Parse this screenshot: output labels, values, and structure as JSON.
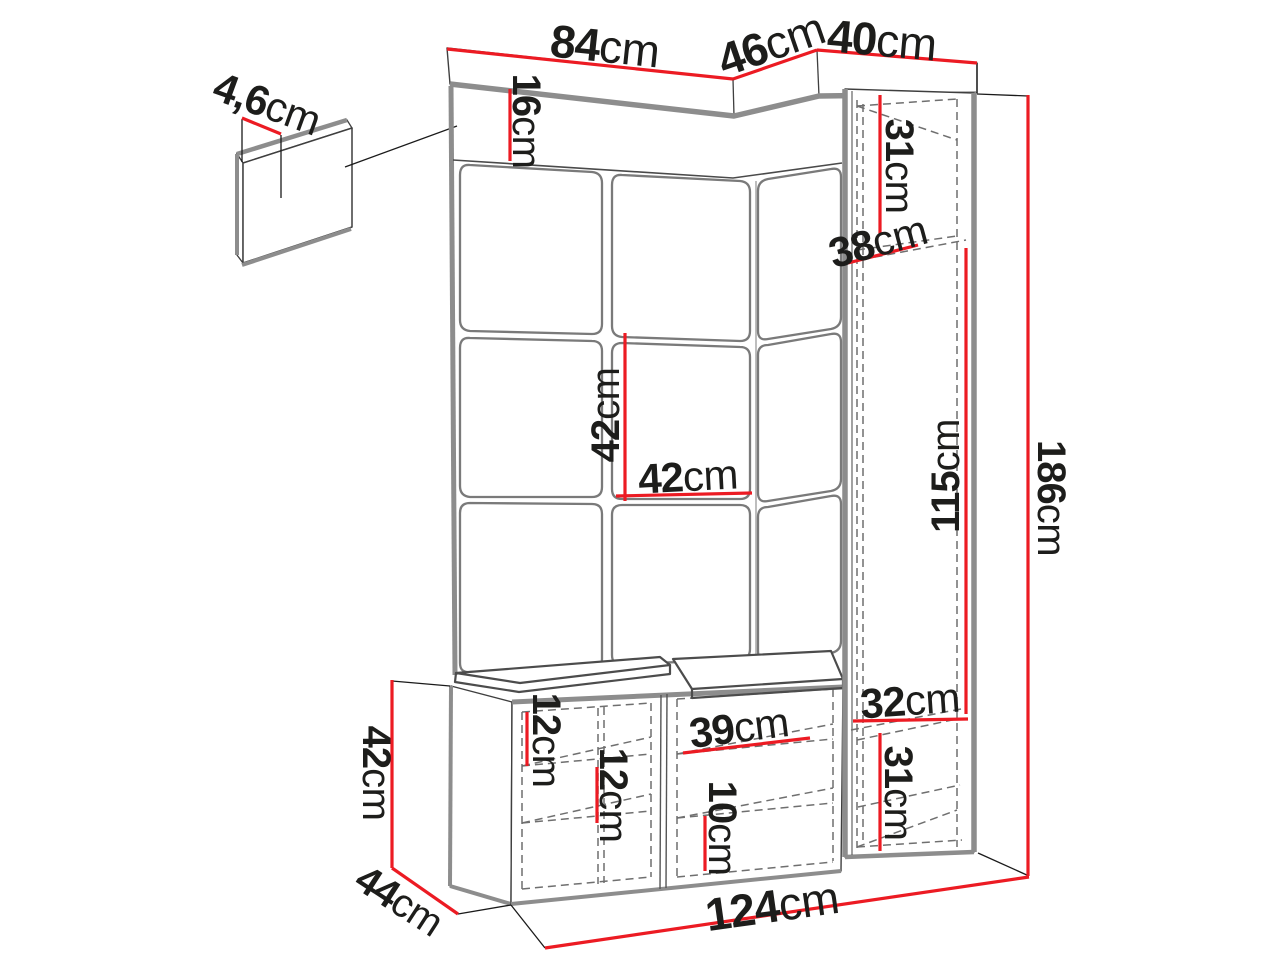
{
  "colors": {
    "dimension_red": "#ec1b23",
    "outline_dark": "#3f3f3f",
    "structure_gray": "#8d8d8d",
    "ink": "#1d1d1b"
  },
  "icons": {
    "coat_hook": "double-coat-hook-icon"
  },
  "labels": [
    {
      "id": "panel-row-top-width",
      "value": "84",
      "unit": "cm"
    },
    {
      "id": "corner-top-depth",
      "value": "46",
      "unit": "cm"
    },
    {
      "id": "cabinet-top-width",
      "value": "40",
      "unit": "cm"
    },
    {
      "id": "wall-hook-panel-thickness",
      "value": "4,6",
      "unit": "cm"
    },
    {
      "id": "hook-rail-height",
      "value": "16",
      "unit": "cm"
    },
    {
      "id": "cabinet-upper-section-height",
      "value": "31",
      "unit": "cm"
    },
    {
      "id": "cabinet-depth",
      "value": "38",
      "unit": "cm"
    },
    {
      "id": "upholstered-panel-height",
      "value": "42",
      "unit": "cm"
    },
    {
      "id": "upholstered-panel-width",
      "value": "42",
      "unit": "cm"
    },
    {
      "id": "cabinet-middle-section-height",
      "value": "115",
      "unit": "cm"
    },
    {
      "id": "total-height",
      "value": "186",
      "unit": "cm"
    },
    {
      "id": "cabinet-shelf-width",
      "value": "32",
      "unit": "cm"
    },
    {
      "id": "cabinet-lower-section-height",
      "value": "31",
      "unit": "cm"
    },
    {
      "id": "bench-upper-gap-height",
      "value": "12",
      "unit": "cm"
    },
    {
      "id": "bench-middle-gap-height",
      "value": "12",
      "unit": "cm"
    },
    {
      "id": "bench-compartment-width",
      "value": "39",
      "unit": "cm"
    },
    {
      "id": "bench-lower-gap-height",
      "value": "10",
      "unit": "cm"
    },
    {
      "id": "bench-height",
      "value": "42",
      "unit": "cm"
    },
    {
      "id": "bench-depth",
      "value": "44",
      "unit": "cm"
    },
    {
      "id": "total-width",
      "value": "124",
      "unit": "cm"
    }
  ]
}
